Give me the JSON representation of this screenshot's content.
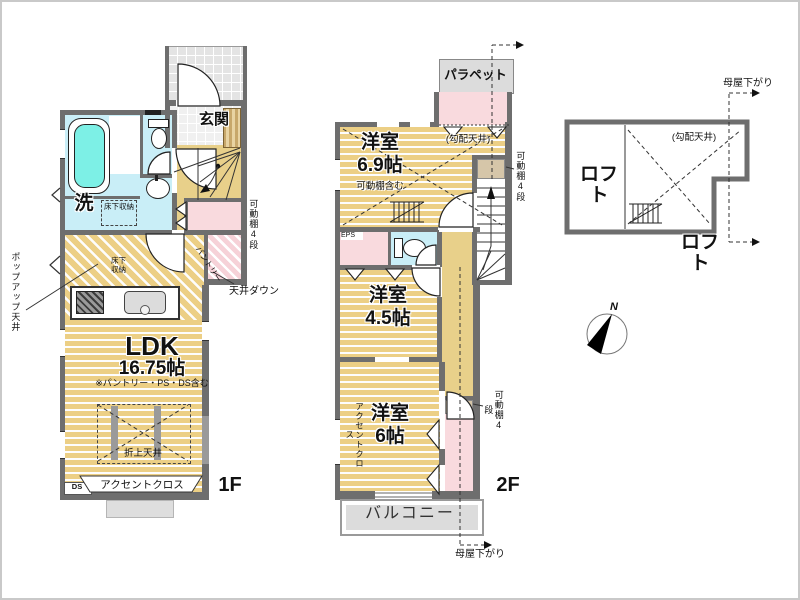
{
  "colors": {
    "floor_wood": "#eccf85",
    "wall": "#6e6e6e",
    "wet_area": "#c9eef7",
    "closet_pink": "#f9dade",
    "balcony_gray": "#dcdcdc",
    "tatami_accent": "#e8d08a"
  },
  "floor1": {
    "label": "1F",
    "entrance": "玄関",
    "wash": "洗",
    "underfloor_storage": "床下収納",
    "ldk": "LDK",
    "ldk_size": "16.75帖",
    "ldk_note": "※パントリー・PS・DS含む",
    "coffered_ceiling": "折上天井",
    "accent_cloth": "アクセントクロス",
    "ds": "DS",
    "pantry": "パントリー",
    "movable_shelf": "可動棚4段",
    "ceiling_down": "天井ダウン",
    "popup_ceiling": "ポップアップ天井"
  },
  "floor2": {
    "label": "2F",
    "parapet": "パラペット",
    "room1": "洋室",
    "room1_size": "6.9帖",
    "room1_note": "可動棚含む",
    "sloped_ceiling": "(勾配天井)",
    "movable_shelf": "可動棚4段",
    "eps": "EPS",
    "room2": "洋室",
    "room2_size": "4.5帖",
    "room3": "洋室",
    "room3_size": "6帖",
    "accent_cloth": "アクセントクロス",
    "balcony": "バルコニー",
    "roof_down": "母屋下がり"
  },
  "loft": {
    "room_label": "ロフト",
    "plan_label": "ロフト",
    "sloped_ceiling": "(勾配天井)",
    "roof_down": "母屋下がり"
  },
  "compass": {
    "north": "N"
  }
}
